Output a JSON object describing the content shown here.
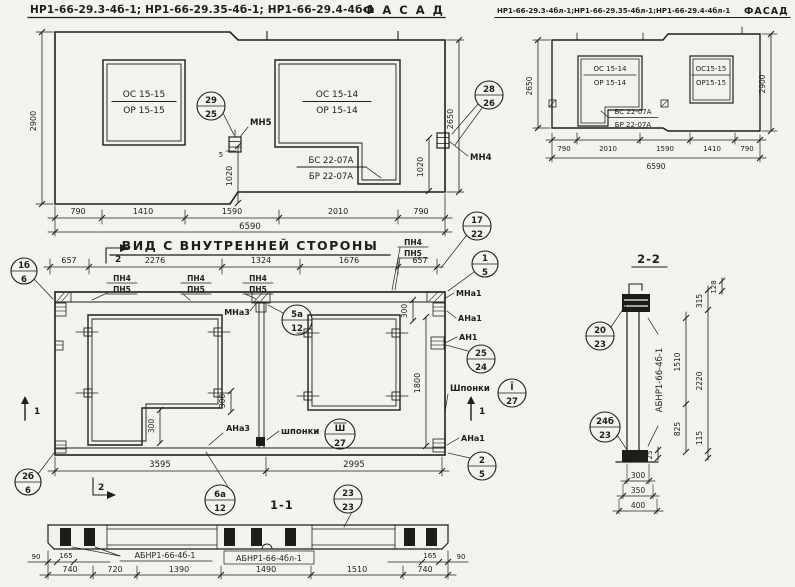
{
  "colors": {
    "paper": "#f3f2ec",
    "ink": "#1e1d1a"
  },
  "titles": {
    "facade_left_codes": "НР1-66-29.3-4б-1; НР1-66-29.35-4б-1; НР1-66-29.4-4б-1",
    "facade_left_word": "Ф А С А Д",
    "facade_right_codes": "НР1-66-29.3-4бл-1;НР1-66-29.35-4бл-1;НР1-66-29.4-4бл-1",
    "facade_right_word": "ФАСАД",
    "inner_view": "ВИД С ВНУТРЕННЕЙ СТОРОНЫ",
    "section_1_1": "1-1",
    "section_2_2": "2-2"
  },
  "facade_left": {
    "window1": {
      "line1": "ОС 15-15",
      "line2": "ОР 15-15"
    },
    "window2": {
      "line1": "ОС 15-14",
      "line2": "ОР 15-14"
    },
    "door": {
      "line1": "БС 22-07А",
      "line2": "БР 22-07А"
    },
    "anchor_mn5": "МН5",
    "anchor_mn4": "МН4",
    "dim_gap": "5",
    "dim_1020": "1020",
    "dim_height_left": "2900",
    "dim_height_right": "2650",
    "dims_bottom": [
      "790",
      "1410",
      "1590",
      "2010",
      "790"
    ],
    "dim_total": "6590"
  },
  "facade_right": {
    "window1": {
      "line1": "ОС 15-14",
      "line2": "ОР 15-14"
    },
    "window2": {
      "line1": "ОС15-15",
      "line2": "ОР15-15"
    },
    "door": {
      "line1": "БС 22-07А",
      "line2": "БР 22-07А"
    },
    "dim_height_left": "2650",
    "dim_height_right": "2900",
    "dims_bottom": [
      "790",
      "2010",
      "1590",
      "1410",
      "790"
    ],
    "dim_total": "6590"
  },
  "inner_view": {
    "dims_top": [
      "657",
      "2276",
      "1324",
      "1676",
      "657"
    ],
    "pn": {
      "top": "ПН4",
      "bottom": "ПН5"
    },
    "labels": {
      "mna3": "МНа3",
      "mna1": "МНа1",
      "ana1": "АНа1",
      "an1": "АН1",
      "ana3": "АНа3",
      "ana1_bottom": "АНа1",
      "shponki_mid": "шпонки",
      "shponki_right": "Шпонки"
    },
    "dims": {
      "d300": "300",
      "d1800": "1800",
      "d3595": "3595",
      "d2995": "2995"
    },
    "markers": {
      "m1": "1",
      "m2": "2"
    }
  },
  "section_1_1": {
    "label_left": "АБНР1-66-4б-1",
    "label_mid": "АБНР1-66-4бл-1",
    "dim_90": "90",
    "dim_165": "165",
    "dims_main": [
      "740",
      "720",
      "1390",
      "1490",
      "1510",
      "740"
    ]
  },
  "section_2_2": {
    "label_vertical": "АБНР1-66-4б-1",
    "dims": {
      "d128": "128",
      "d315": "315",
      "d1510": "1510",
      "d2220": "2220",
      "d825": "825",
      "d115": "115",
      "d25": "25"
    },
    "dims_bottom": [
      "300",
      "350",
      "400"
    ]
  },
  "callouts": {
    "c29_25": {
      "top": "29",
      "bottom": "25"
    },
    "c28_26": {
      "top": "28",
      "bottom": "26"
    },
    "c17_22": {
      "top": "17",
      "bottom": "22"
    },
    "c1_5": {
      "top": "1",
      "bottom": "5"
    },
    "c2_5": {
      "top": "2",
      "bottom": "5"
    },
    "c1b_6": {
      "top": "1б",
      "bottom": "6"
    },
    "c2b_6": {
      "top": "2б",
      "bottom": "6"
    },
    "c5a_12": {
      "top": "5а",
      "bottom": "12"
    },
    "c6a_12": {
      "top": "6а",
      "bottom": "12"
    },
    "c25_24": {
      "top": "25",
      "bottom": "24"
    },
    "cI_27": {
      "top": "Ī",
      "bottom": "27"
    },
    "cIII_27": {
      "top": "Ш",
      "bottom": "27"
    },
    "c23_23": {
      "top": "23",
      "bottom": "23"
    },
    "c20_23": {
      "top": "20",
      "bottom": "23"
    },
    "c24b_23": {
      "top": "24б",
      "bottom": "23"
    }
  }
}
